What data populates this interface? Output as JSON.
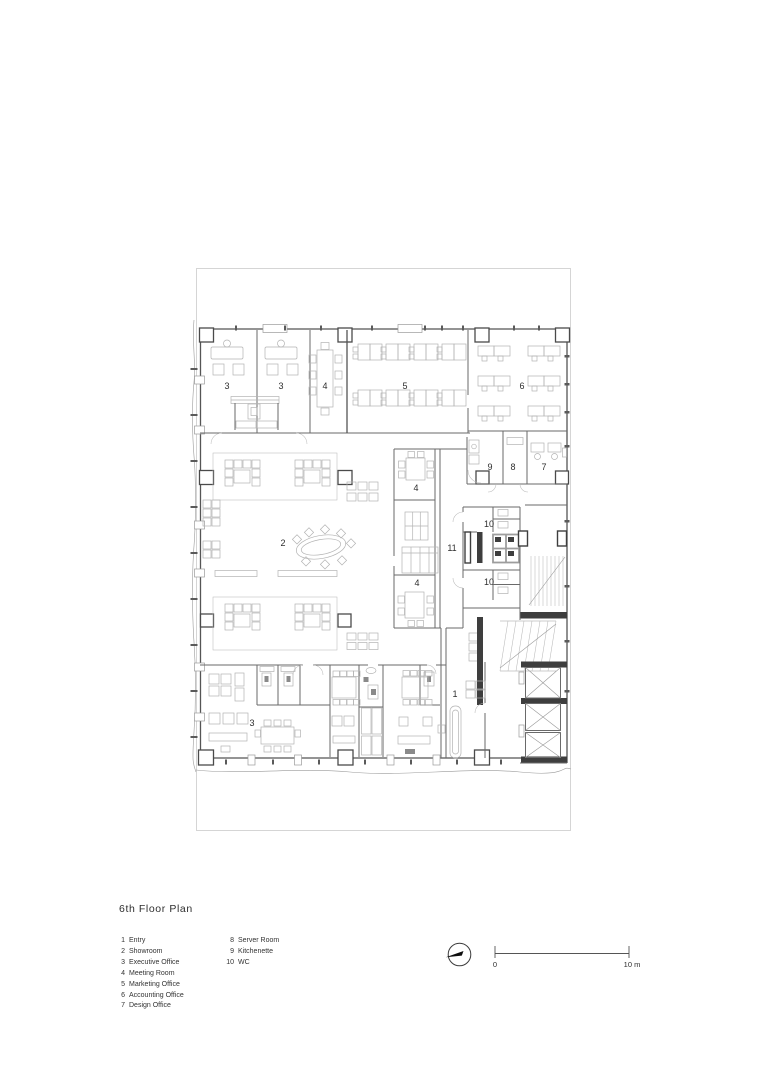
{
  "title": "6th Floor Plan",
  "legend": {
    "column_1": [
      {
        "num": "1",
        "label": "Entry"
      },
      {
        "num": "2",
        "label": "Showroom"
      },
      {
        "num": "3",
        "label": "Executive Office"
      },
      {
        "num": "4",
        "label": "Meeting Room"
      },
      {
        "num": "5",
        "label": "Marketing Office"
      },
      {
        "num": "6",
        "label": "Accounting Office"
      },
      {
        "num": "7",
        "label": "Design Office"
      }
    ],
    "column_2": [
      {
        "num": "8",
        "label": "Server Room"
      },
      {
        "num": "9",
        "label": "Kitchenette"
      },
      {
        "num": "10",
        "label": "WC"
      }
    ]
  },
  "scale_bar": {
    "zero": "0",
    "max": "10 m"
  },
  "plan": {
    "labels": [
      {
        "text": "3"
      },
      {
        "text": "3"
      },
      {
        "text": "4"
      },
      {
        "text": "5"
      },
      {
        "text": "6"
      },
      {
        "text": "9"
      },
      {
        "text": "8"
      },
      {
        "text": "7"
      },
      {
        "text": "4"
      },
      {
        "text": "10"
      },
      {
        "text": "2"
      },
      {
        "text": "11"
      },
      {
        "text": "10"
      },
      {
        "text": "4"
      },
      {
        "text": "1"
      },
      {
        "text": "3"
      }
    ]
  },
  "icons": {
    "north_arrow": "compass-needle-in-circle"
  },
  "colors": {
    "walls": "#6a6a6a",
    "furniture": "#b3b3b3",
    "dark_fill": "#3e3e3e",
    "site_line": "#cbcbcb",
    "text": "#2e2e2e",
    "paper": "#ffffff"
  }
}
